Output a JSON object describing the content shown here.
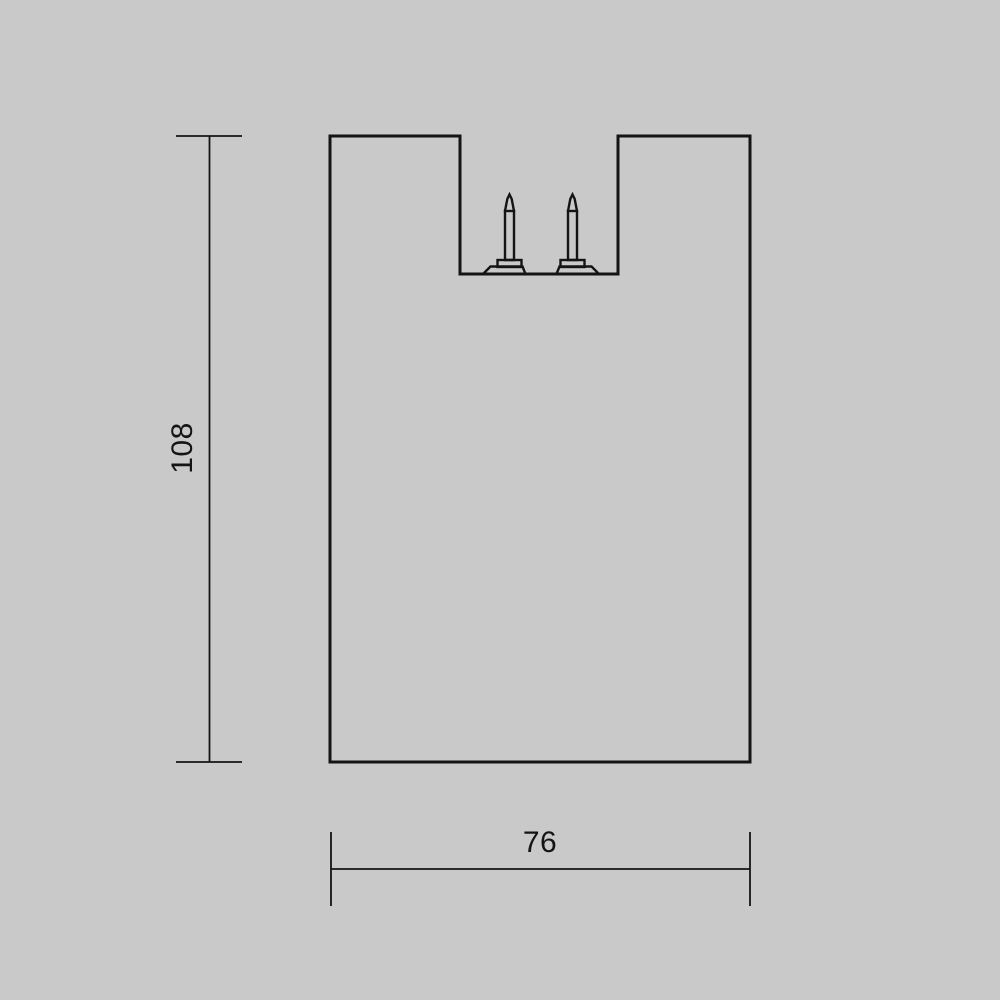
{
  "drawing": {
    "type": "technical-dimension-drawing",
    "subject": "lamp-fixture-front-profile-with-two-contact-pins",
    "dimensions": {
      "height": {
        "value": "108",
        "orientation": "vertical",
        "side": "left"
      },
      "width": {
        "value": "76",
        "orientation": "horizontal",
        "side": "bottom"
      }
    },
    "colors": {
      "background": "#c9c9c9",
      "line": "#141414"
    }
  }
}
